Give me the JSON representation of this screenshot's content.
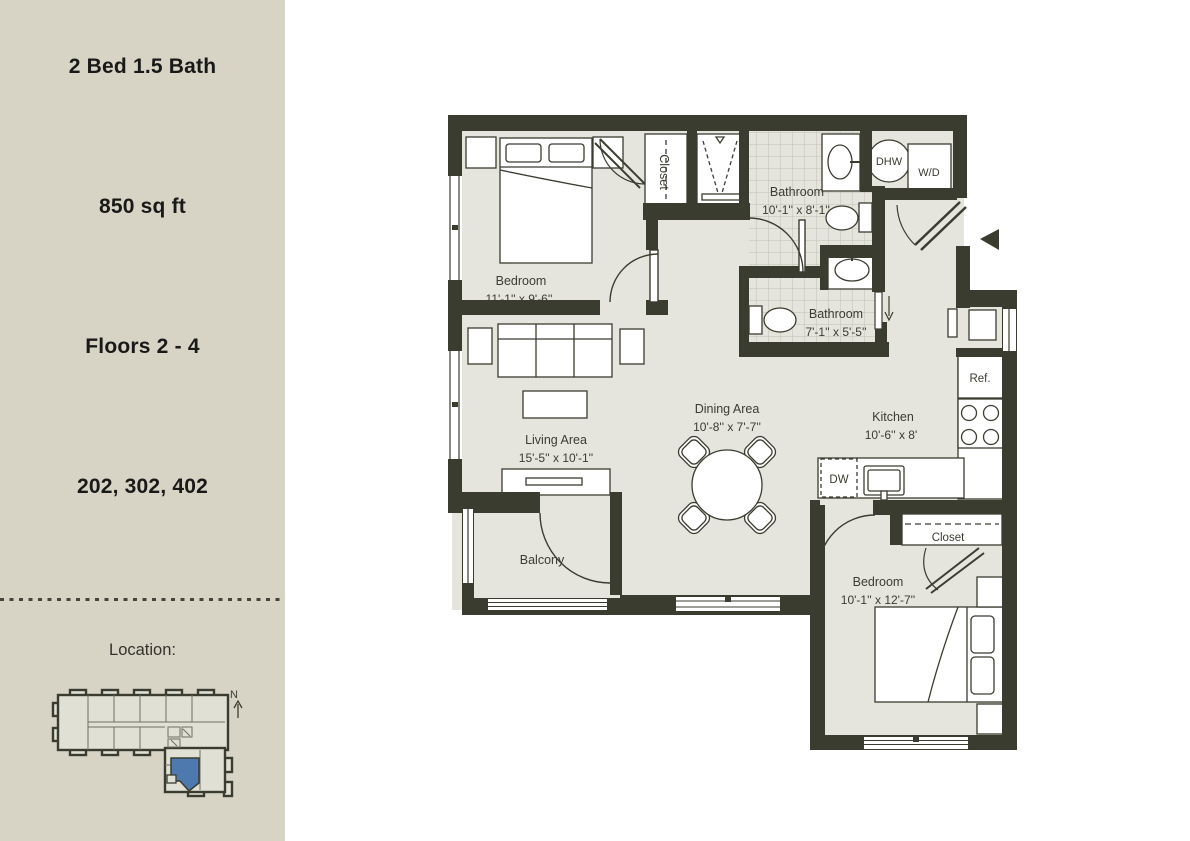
{
  "sidebar": {
    "unit_type": "2 Bed 1.5 Bath",
    "area": "850 sq ft",
    "floors": "Floors 2 - 4",
    "unit_numbers": "202, 302, 402",
    "location_label": "Location:",
    "compass_label": "N",
    "unit_highlight_color": "#4d79ae"
  },
  "floorplan": {
    "rooms": {
      "bedroom1": {
        "name": "Bedroom",
        "dims": "11'-1'' x 9'-6''"
      },
      "closet1": {
        "name": "Closet"
      },
      "bathroom1": {
        "name": "Bathroom",
        "dims": "10'-1'' x 8'-1''"
      },
      "bathroom2": {
        "name": "Bathroom",
        "dims": "7'-1'' x 5'-5''"
      },
      "living": {
        "name": "Living Area",
        "dims": "15'-5'' x 10'-1''"
      },
      "dining": {
        "name": "Dining Area",
        "dims": "10'-8'' x 7'-7''"
      },
      "kitchen": {
        "name": "Kitchen",
        "dims": "10'-6'' x 8'"
      },
      "balcony": {
        "name": "Balcony"
      },
      "closet2": {
        "name": "Closet"
      },
      "bedroom2": {
        "name": "Bedroom",
        "dims": "10'-1'' x 12'-7''"
      }
    },
    "labels": {
      "dhw": "DHW",
      "washer_dryer": "W/D",
      "refrigerator": "Ref.",
      "dishwasher": "DW"
    },
    "colors": {
      "wall": "#3b3c30",
      "floor": "#e6e5dd",
      "sidebar_bg": "#d7d4c6"
    }
  }
}
